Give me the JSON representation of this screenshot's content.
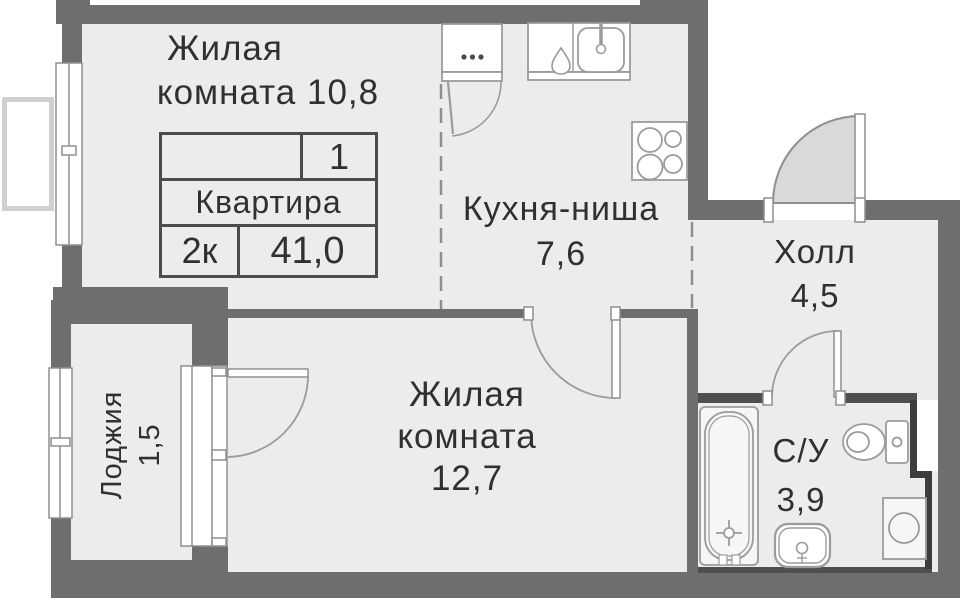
{
  "apartment_card": {
    "position": "1",
    "label": "Квартира",
    "rooms_count": "2к",
    "total_area": "41,0"
  },
  "rooms": {
    "living_room_1": {
      "line1": "Жилая",
      "line2": "комната 10,8"
    },
    "kitchen_niche": {
      "line1": "Кухня-ниша",
      "line2": "7,6"
    },
    "hall": {
      "line1": "Холл",
      "line2": "4,5"
    },
    "living_room_2": {
      "line1": "Жилая",
      "line2": "комната",
      "line3": "12,7"
    },
    "loggia": {
      "line1": "Лоджия",
      "line2": "1,5"
    },
    "bathroom": {
      "line1": "С/У",
      "line2": "3,9"
    }
  },
  "fixtures": [
    "bathtub",
    "toilet",
    "bathroom-sink",
    "washing-machine",
    "kitchen-sink",
    "kitchen-counter",
    "stove",
    "ventilation-cabinet",
    "entrance-door",
    "balcony-door",
    "interior-doors",
    "windows",
    "duct-shaft"
  ],
  "colors": {
    "wall": "#6e6e6e",
    "wall_dark": "#4f4f4f",
    "wall_thin_dark": "#3d3d3d",
    "floor": "#ececec",
    "fixture_stroke": "#9b9b9b",
    "door_leaf_fill": "#d9d9d9",
    "dashed_line": "#8f8f8f",
    "text": "#303030",
    "table_border": "#4c4c4c",
    "exterior_outline": "#d0d0d0"
  }
}
